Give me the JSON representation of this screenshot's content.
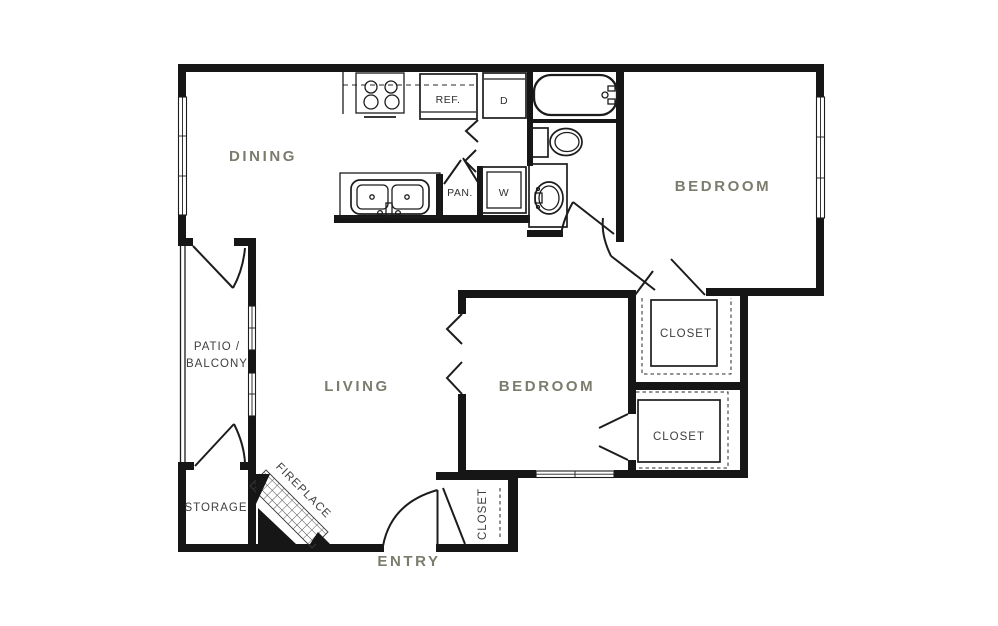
{
  "title": "Two bedroom apartment floor plan",
  "colors": {
    "background": "#ffffff",
    "wall": "#161616",
    "room_label": "#7c7c6d",
    "fixture_label": "#3e3e3c"
  },
  "rooms": {
    "dining": "DINING",
    "bedroom_top": "BEDROOM",
    "living": "LIVING",
    "bedroom_mid": "BEDROOM",
    "entry": "ENTRY"
  },
  "areas": {
    "patio_line1": "PATIO /",
    "patio_line2": "BALCONY",
    "storage": "STORAGE",
    "fireplace": "FIREPLACE",
    "closet_hall": "CLOSET",
    "closet_bedroom": "CLOSET",
    "closet_entry": "CLOSET"
  },
  "fixtures": {
    "refrigerator": "REF.",
    "pantry": "PAN.",
    "dryer": "D",
    "washer": "W"
  }
}
